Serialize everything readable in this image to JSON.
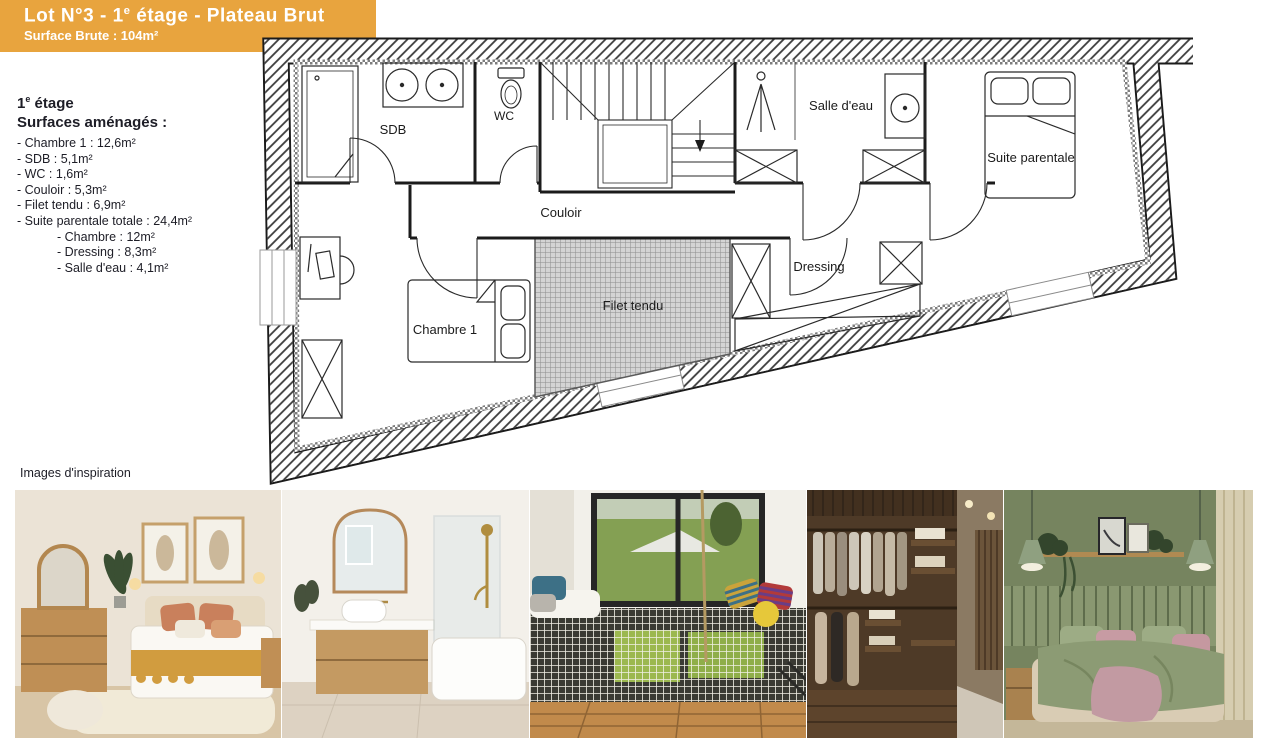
{
  "banner": {
    "title_prefix": "Lot N°3 - 1",
    "title_sup": "e",
    "title_suffix": " étage - Plateau Brut",
    "subtitle": "Surface Brute : 104m²",
    "color": "#E8A43E"
  },
  "surfaces": {
    "heading_prefix": "1",
    "heading_sup": "e",
    "heading_suffix": " étage",
    "subheading": "Surfaces aménagés :",
    "items": [
      {
        "text": "- Chambre 1 : 12,6m²",
        "indent": 0
      },
      {
        "text": "- SDB : 5,1m²",
        "indent": 0
      },
      {
        "text": "- WC : 1,6m²",
        "indent": 0
      },
      {
        "text": "- Couloir : 5,3m²",
        "indent": 0
      },
      {
        "text": "- Filet tendu : 6,9m²",
        "indent": 0
      },
      {
        "text": "- Suite parentale totale : 24,4m²",
        "indent": 0
      },
      {
        "text": "- Chambre : 12m²",
        "indent": 1
      },
      {
        "text": "- Dressing : 8,3m²",
        "indent": 1
      },
      {
        "text": "- Salle d'eau : 4,1m²",
        "indent": 1
      }
    ]
  },
  "plan": {
    "rooms": {
      "sdb": "SDB",
      "wc": "WC",
      "couloir": "Couloir",
      "salle_deau": "Salle d'eau",
      "suite_parentale": "Suite parentale",
      "dressing": "Dressing",
      "chambre1": "Chambre 1",
      "filet": "Filet tendu"
    }
  },
  "inspiration": {
    "caption": "Images d'inspiration",
    "photos": [
      {
        "name": "warm-boho-bedroom"
      },
      {
        "name": "bathroom-arched-mirror-tub"
      },
      {
        "name": "suspended-net-over-window"
      },
      {
        "name": "walk-in-closet-dark-wood"
      },
      {
        "name": "sage-green-bedroom"
      }
    ]
  },
  "colors": {
    "banner_orange": "#E8A43E",
    "plan_ink": "#1b1b1b",
    "net_gray": "#d4d4d4"
  }
}
